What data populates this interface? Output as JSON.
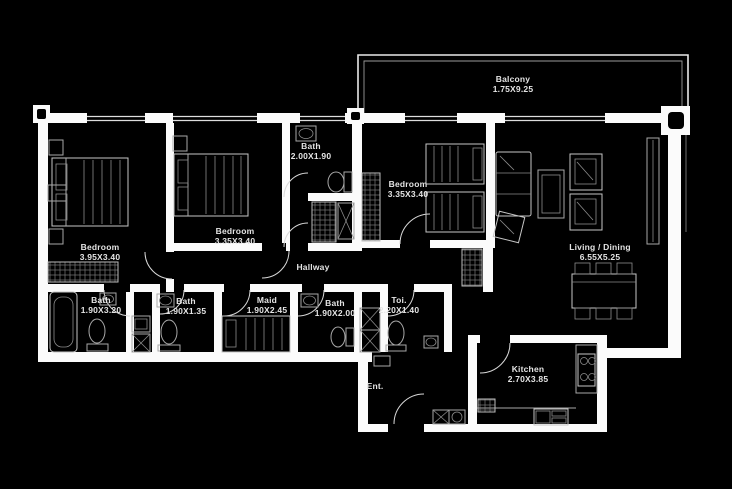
{
  "plan_title": "Apartment floor plan",
  "colors": {
    "background": "#000000",
    "walls": "#fbfbfb",
    "furniture_lines": "#a8a8a8",
    "label_text": "#e4e4e4"
  },
  "rooms": {
    "balcony": {
      "name": "Balcony",
      "dims": "1.75X9.25"
    },
    "bedroom1": {
      "name": "Bedroom",
      "dims": "3.95X3.40"
    },
    "bedroom2": {
      "name": "Bedroom",
      "dims": "3.35X3.40"
    },
    "bath_top": {
      "name": "Bath",
      "dims": "2.00X1.90"
    },
    "bedroom3": {
      "name": "Bedroom",
      "dims": "3.35X3.40"
    },
    "living": {
      "name": "Living / Dining",
      "dims": "6.55X5.25"
    },
    "hallway": {
      "name": "Hallway",
      "dims": ""
    },
    "bath1": {
      "name": "Bath",
      "dims": "1.90X3.20"
    },
    "bath2": {
      "name": "Bath",
      "dims": "1.90X1.35"
    },
    "maid": {
      "name": "Maid",
      "dims": "1.90X2.45"
    },
    "bath3": {
      "name": "Bath",
      "dims": "1.90X2.00"
    },
    "toi": {
      "name": "Toi.",
      "dims": "2.20X1.40"
    },
    "ent": {
      "name": "Ent.",
      "dims": ""
    },
    "kitchen": {
      "name": "Kitchen",
      "dims": "2.70X3.85"
    }
  }
}
